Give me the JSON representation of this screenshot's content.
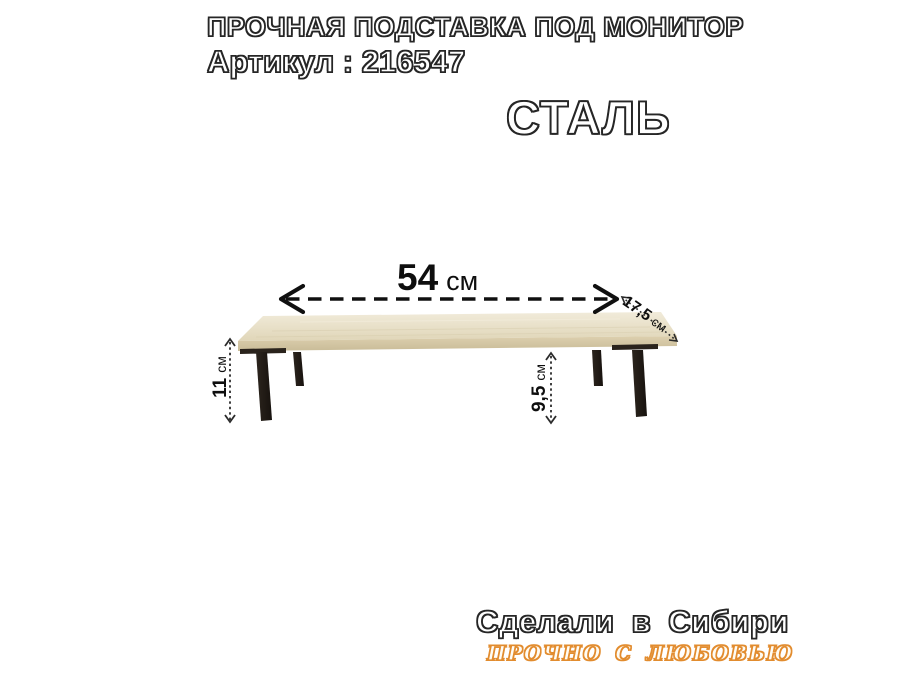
{
  "header": {
    "title": "ПРОЧНАЯ ПОДСТАВКА ПОД МОНИТОР",
    "article": "Артикул : 216547",
    "material": "СТАЛЬ"
  },
  "diagram": {
    "width": {
      "value": "54",
      "unit": "см"
    },
    "depth": {
      "value": "17,5",
      "unit": "см"
    },
    "height_left": {
      "value": "11",
      "unit": "см"
    },
    "height_mid": {
      "value": "9,5",
      "unit": "см"
    }
  },
  "footer": {
    "made_in": "Сделали в Сибири",
    "slogan": "ПРОЧНО С ЛЮБОВЬЮ"
  },
  "colors": {
    "background": "#ffffff",
    "outline_text": "#262626",
    "dimension_text": "#0e0e0e",
    "accent_orange": "#e28c2f",
    "wood_top_light": "#f0e9d7",
    "wood_top_dark": "#e0d6b8",
    "wood_edge_dark": "#c9bc98",
    "leg_black": "#211b16"
  }
}
